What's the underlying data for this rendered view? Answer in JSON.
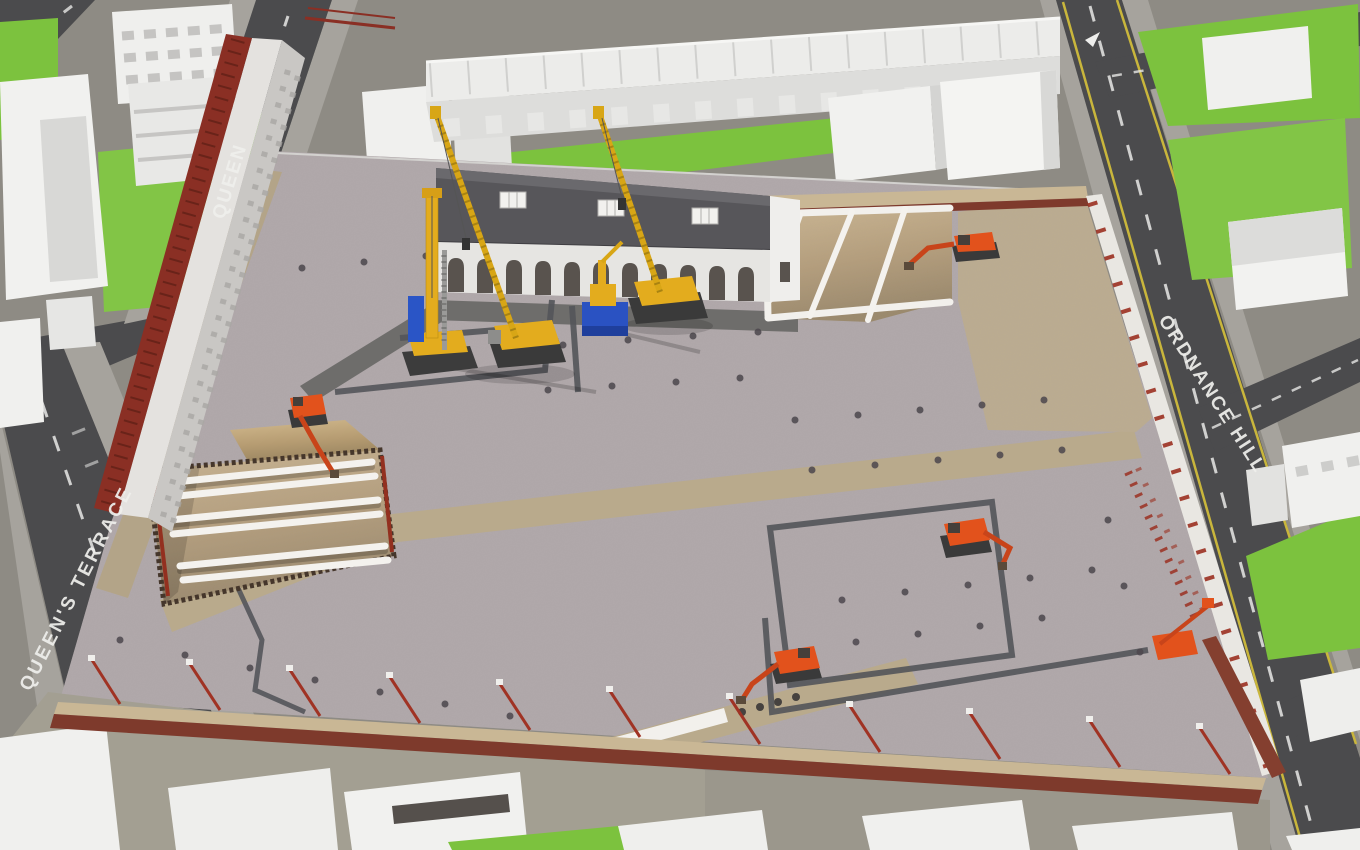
{
  "scene": {
    "description": "Aerial 3D construction site visualisation - excavation and piling stage",
    "view": "isometric aerial render"
  },
  "streets": {
    "left": {
      "name": "QUEEN'S TERRACE"
    },
    "top_left": {
      "name": "QUEEN"
    },
    "right": {
      "name": "ORDNANCE HILL"
    }
  },
  "site": {
    "equipment": [
      {
        "id": "piling-rig",
        "color": "#e3ac1e"
      },
      {
        "id": "crawler-crane-1",
        "color": "#e3ac1e"
      },
      {
        "id": "crawler-crane-2",
        "color": "#e3ac1e"
      },
      {
        "id": "mini-crane-blue-base",
        "color": "#2a52c2"
      },
      {
        "id": "excavator-north-pit",
        "color": "#e2521c"
      },
      {
        "id": "excavator-east",
        "color": "#e2521c"
      },
      {
        "id": "excavator-south",
        "color": "#e2521c"
      },
      {
        "id": "excavator-west-pit",
        "color": "#e2521c"
      },
      {
        "id": "boom-lift-east",
        "color": "#e2521c"
      }
    ],
    "features": [
      "west-excavation-pit-with-tubular-struts",
      "north-excavation-pit-with-capping-beam",
      "sheet-pile-walls",
      "pile-head-grid",
      "haul-roads",
      "perimeter-brick-wall-with-raking-shores",
      "facade-retention-red-scaffold"
    ]
  },
  "colors": {
    "gravel": "#b6acae",
    "soil": "#c3a87b",
    "road": "#4b4b4d",
    "grass": "#7cc23e",
    "crane_yellow": "#e3ac1e",
    "excavator_orange": "#e2521c",
    "strut_white": "#f4f2ee",
    "brick_red": "#7e3a2c",
    "scaffold_red": "#8a2f24",
    "marking_white": "#f2f2f2",
    "edge_line_yellow": "#c9b63c"
  }
}
